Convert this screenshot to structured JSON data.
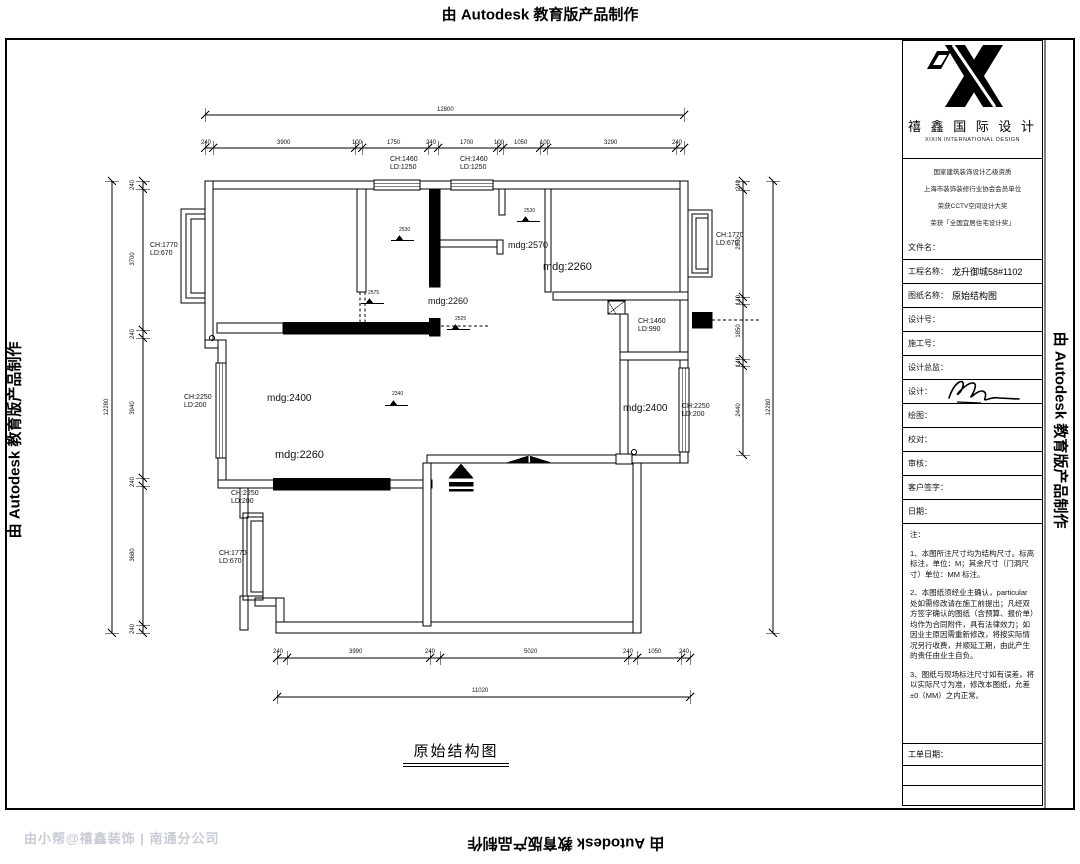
{
  "watermarks": {
    "top": "由 Autodesk 教育版产品制作",
    "bottom": "由 Autodesk 教育版产品制作",
    "left": "由 Autodesk 教育版产品制作",
    "right": "由 Autodesk 教育版产品制作",
    "corner": "由小帮@禧鑫装饰 | 南通分公司"
  },
  "plan": {
    "title": "原始结构图",
    "labels": [
      {
        "t": "12800",
        "x": 437,
        "y": 107
      },
      {
        "t": "240",
        "x": 201,
        "y": 140
      },
      {
        "t": "3900",
        "x": 277,
        "y": 140
      },
      {
        "t": "100",
        "x": 352,
        "y": 140
      },
      {
        "t": "1750",
        "x": 387,
        "y": 140
      },
      {
        "t": "240",
        "x": 426,
        "y": 140
      },
      {
        "t": "1700",
        "x": 460,
        "y": 140
      },
      {
        "t": "100",
        "x": 494,
        "y": 140
      },
      {
        "t": "1050",
        "x": 514,
        "y": 140
      },
      {
        "t": "100",
        "x": 540,
        "y": 140
      },
      {
        "t": "3290",
        "x": 604,
        "y": 140
      },
      {
        "t": "240",
        "x": 672,
        "y": 140
      },
      {
        "t": "12280",
        "x": 104,
        "y": 407,
        "r": -90
      },
      {
        "t": "240",
        "x": 130,
        "y": 185,
        "r": -90
      },
      {
        "t": "3700",
        "x": 130,
        "y": 259,
        "r": -90
      },
      {
        "t": "240",
        "x": 130,
        "y": 334,
        "r": -90
      },
      {
        "t": "3940",
        "x": 130,
        "y": 408,
        "r": -90
      },
      {
        "t": "240",
        "x": 130,
        "y": 482,
        "r": -90
      },
      {
        "t": "3680",
        "x": 130,
        "y": 555,
        "r": -90
      },
      {
        "t": "240",
        "x": 130,
        "y": 629,
        "r": -90
      },
      {
        "t": "240",
        "x": 736,
        "y": 185,
        "r": -90
      },
      {
        "t": "2930",
        "x": 736,
        "y": 243,
        "r": -90
      },
      {
        "t": "140",
        "x": 736,
        "y": 300,
        "r": -90
      },
      {
        "t": "1850",
        "x": 736,
        "y": 331,
        "r": -90
      },
      {
        "t": "140",
        "x": 736,
        "y": 362,
        "r": -90
      },
      {
        "t": "2440",
        "x": 736,
        "y": 410,
        "r": -90
      },
      {
        "t": "12280",
        "x": 766,
        "y": 407,
        "r": -90
      },
      {
        "t": "240",
        "x": 273,
        "y": 649
      },
      {
        "t": "3990",
        "x": 349,
        "y": 649
      },
      {
        "t": "240",
        "x": 425,
        "y": 649
      },
      {
        "t": "5020",
        "x": 524,
        "y": 649
      },
      {
        "t": "240",
        "x": 623,
        "y": 649
      },
      {
        "t": "1050",
        "x": 648,
        "y": 649
      },
      {
        "t": "240",
        "x": 679,
        "y": 649
      },
      {
        "t": "11020",
        "x": 472,
        "y": 688
      },
      {
        "t": "CH:1460\nLD:1250",
        "x": 390,
        "y": 156,
        "s": 7
      },
      {
        "t": "CH:1460\nLD:1250",
        "x": 460,
        "y": 156,
        "s": 7
      },
      {
        "t": "CH:1770\nLD:670",
        "x": 150,
        "y": 242,
        "s": 7
      },
      {
        "t": "CH:2250\nLD:200",
        "x": 184,
        "y": 394,
        "s": 7
      },
      {
        "t": "CH:2250\nLD:200",
        "x": 231,
        "y": 490,
        "s": 7
      },
      {
        "t": "CH:1770\nLD:670",
        "x": 219,
        "y": 550,
        "s": 7
      },
      {
        "t": "CH:1770\nLD:670",
        "x": 716,
        "y": 232,
        "s": 7
      },
      {
        "t": "CH:1460\nLD:990",
        "x": 638,
        "y": 318,
        "s": 7
      },
      {
        "t": "CH:2250\nLD:200",
        "x": 682,
        "y": 403,
        "s": 7
      },
      {
        "t": "mdg:2570",
        "x": 508,
        "y": 240,
        "s": 9
      },
      {
        "t": "mdg:2260",
        "x": 543,
        "y": 261,
        "s": 11
      },
      {
        "t": "mdg:2260",
        "x": 428,
        "y": 296,
        "s": 9
      },
      {
        "t": "mdg:2260",
        "x": 275,
        "y": 449,
        "s": 11
      },
      {
        "t": "mdg:2400",
        "x": 267,
        "y": 393,
        "s": 10
      },
      {
        "t": "mdg:2400",
        "x": 623,
        "y": 403,
        "s": 10
      },
      {
        "t": "2530",
        "x": 399,
        "y": 228,
        "s": 5
      },
      {
        "t": "2530",
        "x": 524,
        "y": 209,
        "s": 5
      },
      {
        "t": "2575",
        "x": 368,
        "y": 291,
        "s": 5
      },
      {
        "t": "2525",
        "x": 455,
        "y": 317,
        "s": 5
      },
      {
        "t": "2340",
        "x": 392,
        "y": 392,
        "s": 5
      }
    ]
  },
  "title_block": {
    "company_cn": "禧 鑫 国 际 设 计",
    "company_en": "XIXIN INTERNATIONAL DESIGN",
    "credentials": [
      "国家建筑装饰设计乙级资质",
      "上海市装饰装修行业协会会员单位",
      "荣获CCTV空间设计大奖",
      "荣获「全国宜居住宅设计奖」"
    ],
    "fields": [
      {
        "label": "文件名：",
        "value": ""
      },
      {
        "label": "工程名称：",
        "value": "龙升御城58#1102"
      },
      {
        "label": "图纸名称：",
        "value": "原始结构图"
      },
      {
        "label": "设计号：",
        "value": ""
      },
      {
        "label": "施工号：",
        "value": ""
      },
      {
        "label": "设计总监：",
        "value": ""
      },
      {
        "label": "设计：",
        "value": ""
      },
      {
        "label": "绘图：",
        "value": ""
      },
      {
        "label": "校对：",
        "value": ""
      },
      {
        "label": "审核：",
        "value": ""
      },
      {
        "label": "客户签字：",
        "value": ""
      },
      {
        "label": "日期：",
        "value": ""
      }
    ],
    "notes_title": "注：",
    "notes": [
      "1、本图所注尺寸均为结构尺寸。标高标注，单位：M；其余尺寸（门洞尺寸）单位：MM 标注。",
      "2、本图纸须经业主确认，particular处如需修改请在施工前提出；凡经双方签字确认的图纸（含预算、报价单）均作为合同附件，具有法律效力；如因业主原因需重新修改，将按实际情况另行收费，并顺延工期，由此产生的责任由业主自负。",
      "3、图纸与现场标注尺寸如有误差，将以实际尺寸为准，修改本图纸，允差±0（MM）之内正常。"
    ],
    "order_date_label": "工单日期："
  }
}
